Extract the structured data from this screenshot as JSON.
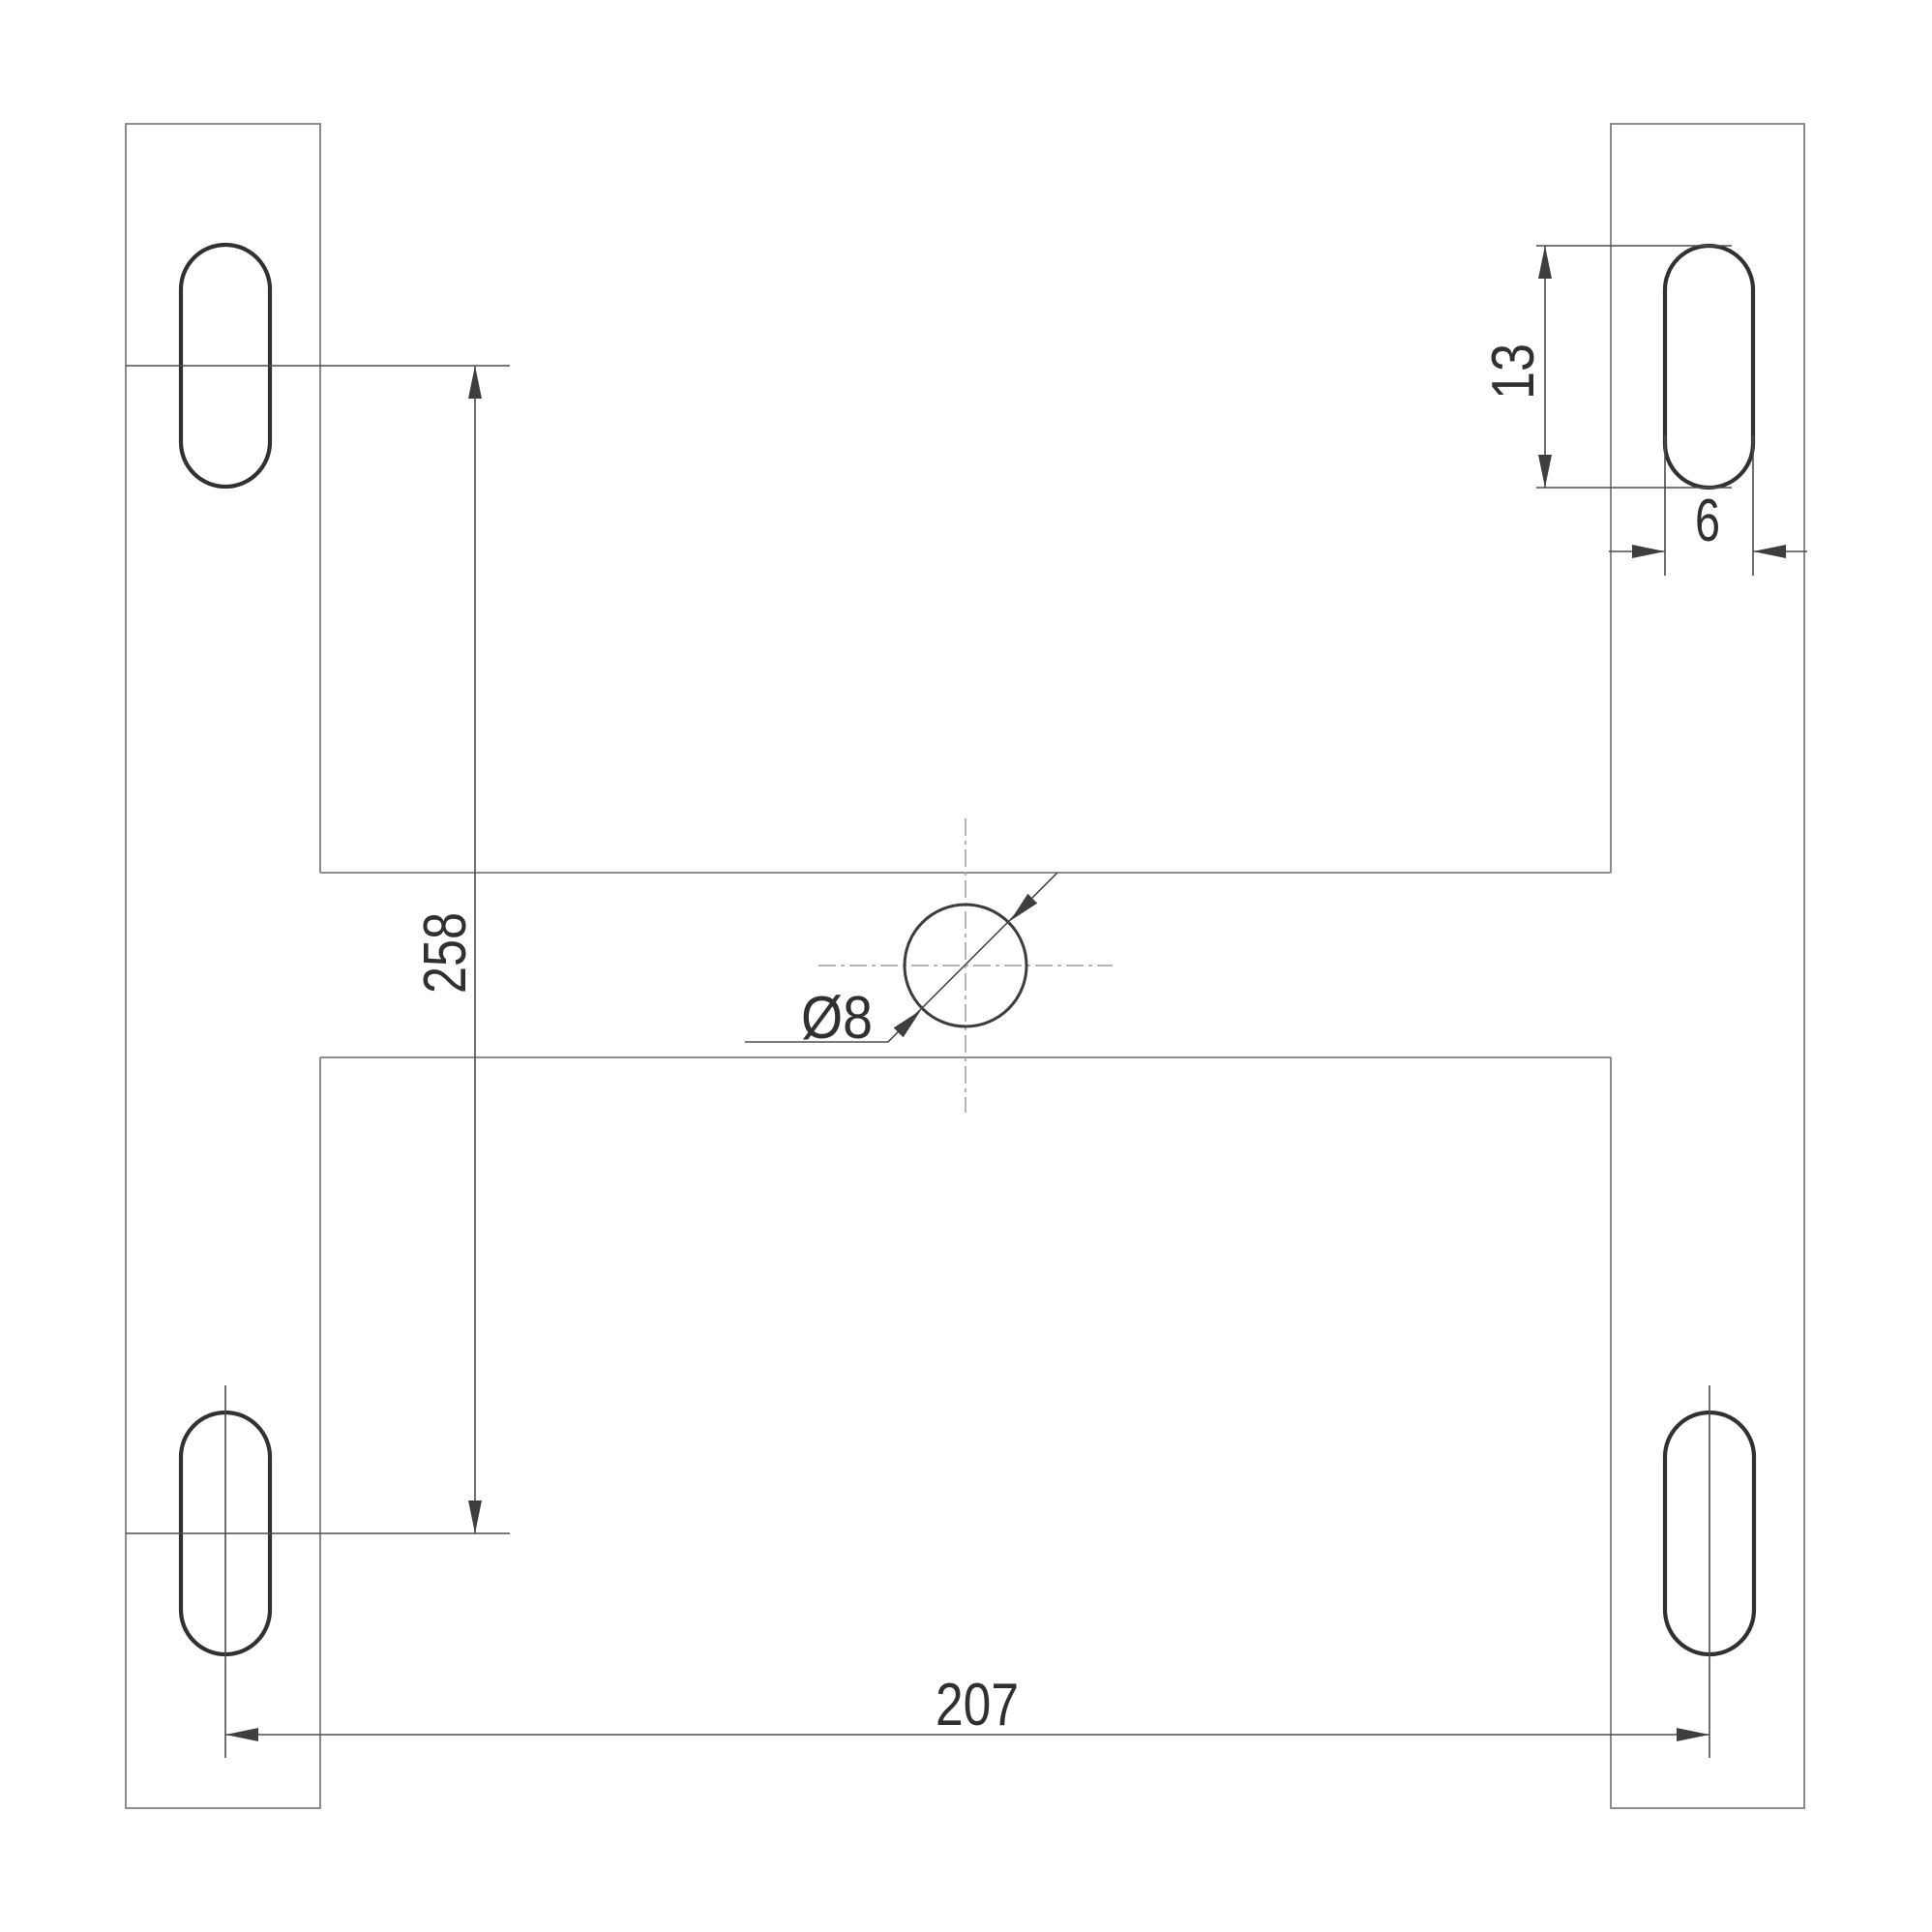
{
  "drawing": {
    "type": "technical-dimension-drawing",
    "background": "#ffffff",
    "part": "h-shaped mounting plate, top view",
    "dimensions": {
      "slot_vertical_spacing": "258",
      "slot_horizontal_spacing": "207",
      "slot_length": "13",
      "slot_width": "6",
      "center_hole_diameter": "Ø8"
    },
    "features": {
      "mounting_slot_count": 4,
      "center_hole_count": 1
    },
    "colors": {
      "body_outline": "#7b7d7f",
      "slot_outline": "#2f3133",
      "hole_outline": "#3a3c3e",
      "dimension_lines": "#4b4d4f",
      "centerlines": "#a6a8aa",
      "text": "#2e3032"
    }
  }
}
